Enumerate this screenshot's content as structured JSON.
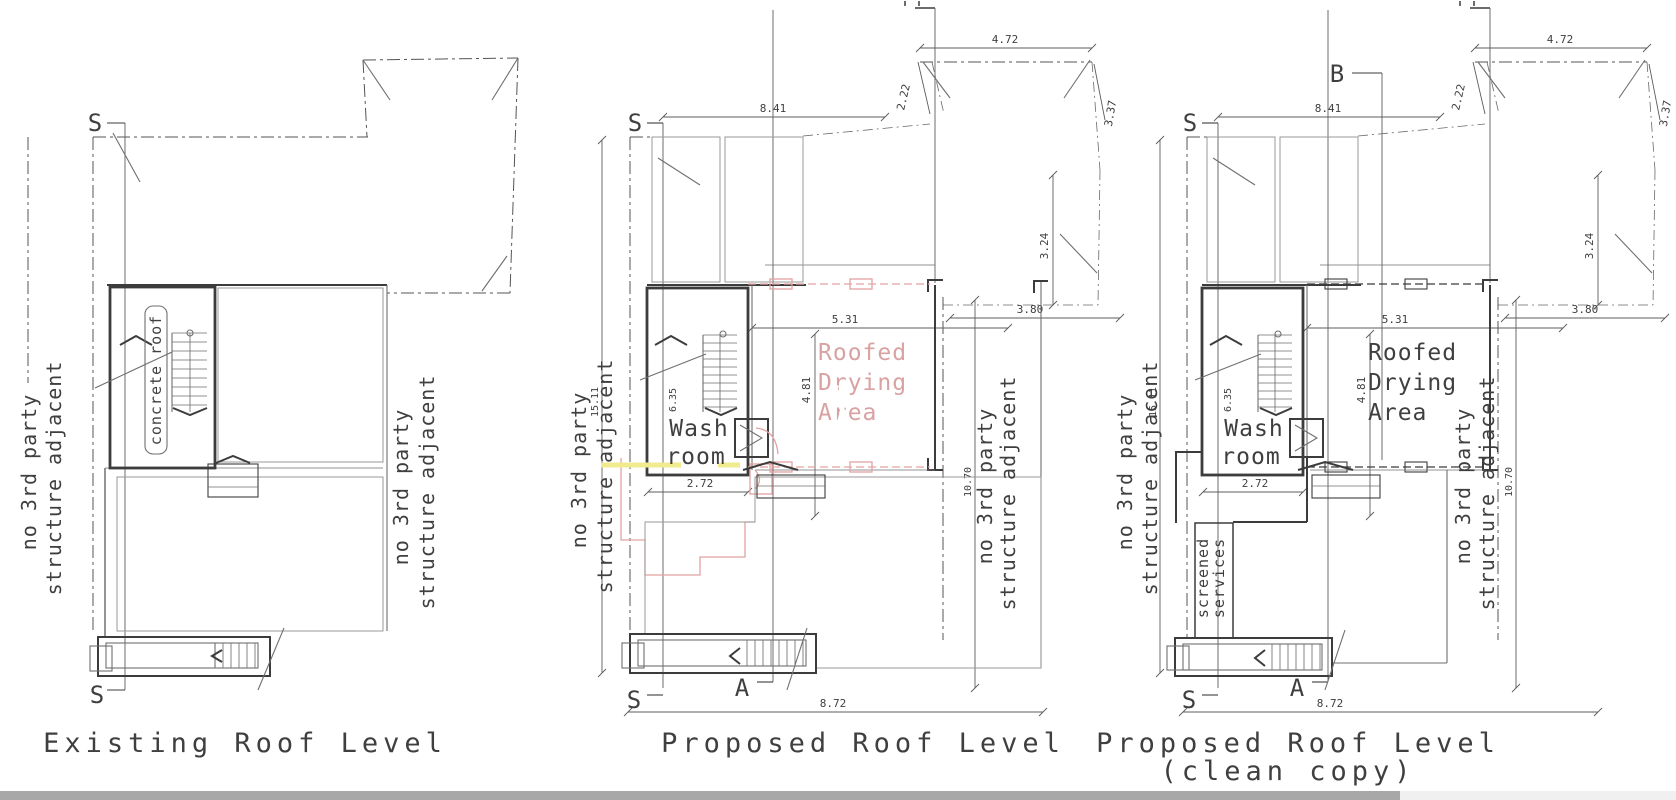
{
  "document": {
    "type": "architectural-roof-plan-drawing",
    "colors": {
      "ink": "#3c3c3c",
      "tile_grid": "#ababab",
      "proposed_red": "#e2a2a2",
      "demolition_yellow": "#f0eb8e",
      "pin_watermark": "#6b7e8c",
      "footer_bar_dark": "#a8a8a8",
      "footer_bar_light": "#f0f0f0"
    }
  },
  "plans": [
    {
      "title": "Existing Roof Level",
      "side_left": [
        "no 3rd party",
        "structure adjacent"
      ],
      "side_right": [
        "no 3rd party",
        "structure adjacent"
      ],
      "markers": {
        "s": "S"
      },
      "labels": {
        "concrete_roof": "concrete roof"
      }
    },
    {
      "title": "Proposed Roof Level",
      "side_left": [
        "no 3rd party",
        "structure adjacent"
      ],
      "side_right": [
        "no 3rd party",
        "structure adjacent"
      ],
      "markers": {
        "s": "S",
        "a": "A"
      },
      "labels": {
        "wash": "Wash",
        "room": "room",
        "roofed": "Roofed",
        "drying": "Drying",
        "area": "Area"
      },
      "dims": {
        "top_width": "8.41",
        "neighbour_width": "4.72",
        "neighbour_side": "2.22",
        "neighbour_right": "3.37",
        "neighbour_depth": "3.24",
        "setback": "3.80",
        "drying_width": "5.31",
        "drying_depth": "4.81",
        "wash_width": "2.72",
        "bottom_width": "8.72",
        "stair_depth": "6.35",
        "left_height": "15.11",
        "right_height": "10.70"
      }
    },
    {
      "title": "Proposed Roof Level",
      "subtitle": "(clean copy)",
      "side_left": [
        "no 3rd party",
        "structure adjacent"
      ],
      "side_right": [
        "no 3rd party",
        "structure adjacent"
      ],
      "markers": {
        "s": "S",
        "a": "A",
        "b": "B"
      },
      "labels": {
        "wash": "Wash",
        "room": "room",
        "roofed": "Roofed",
        "drying": "Drying",
        "area": "Area",
        "screened": "screened",
        "services": "services"
      },
      "dims": {
        "top_width": "8.41",
        "neighbour_width": "4.72",
        "neighbour_side": "2.22",
        "neighbour_right": "3.37",
        "neighbour_depth": "3.24",
        "setback": "3.80",
        "drying_width": "5.31",
        "drying_depth": "4.81",
        "wash_width": "2.72",
        "bottom_width": "8.72",
        "stair_depth": "6.35",
        "left_height": "15.11",
        "right_height": "10.70"
      }
    }
  ]
}
